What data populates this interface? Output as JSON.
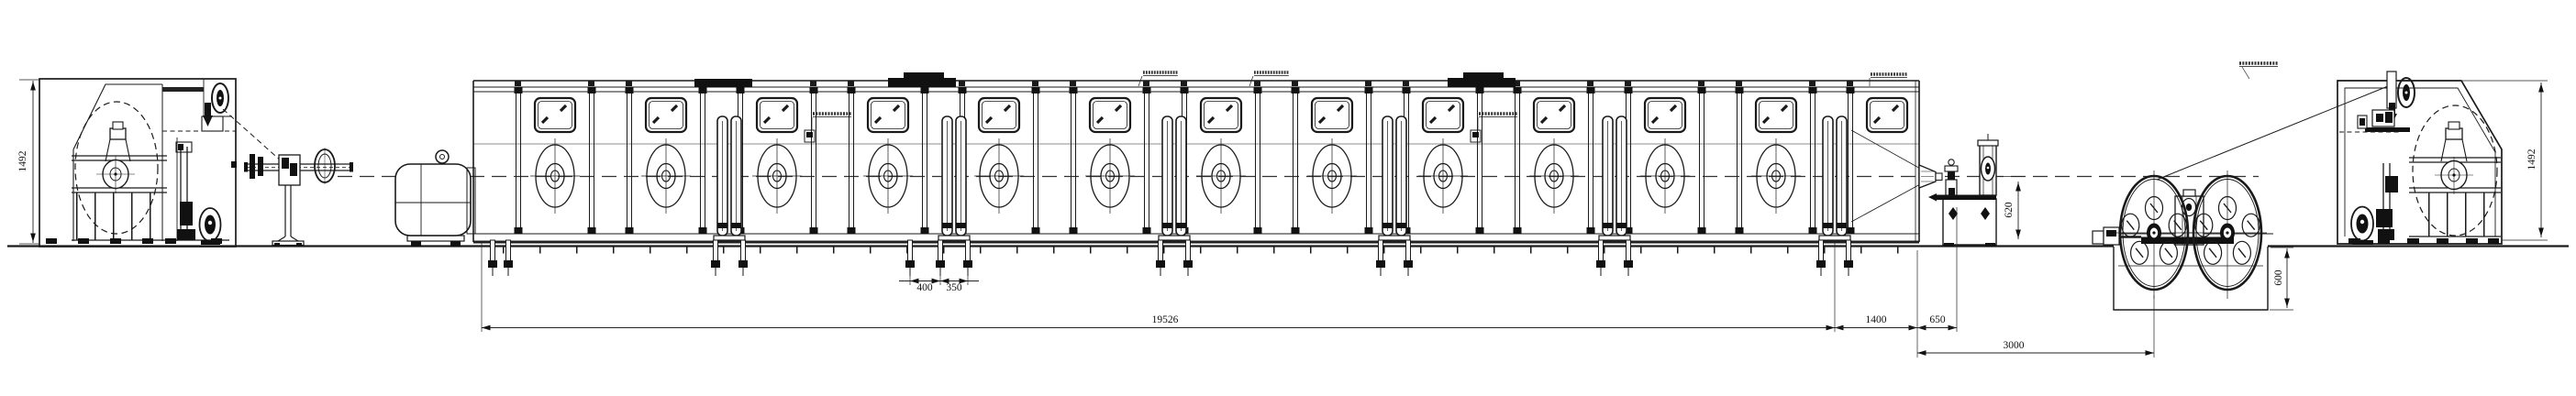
{
  "palette": {
    "ink": "#1a1a1a",
    "dim": "#222222",
    "background": "#ffffff"
  },
  "dimensions": {
    "payoff_height": "1492",
    "takeup_height": "1492",
    "main_line_length": "19526",
    "line_to_capstan": "1400",
    "capstan_stand_width": "650",
    "capstan_to_takeup_wheel": "3000",
    "anchor_bolt_pitch_left": "400",
    "anchor_bolt_pitch_right": "350",
    "capstan_centerline_height": "620",
    "pit_depth": "600"
  },
  "annotations": {
    "note": "six tiny leader labels, text illegible at source resolution",
    "items": [
      {
        "id": "ann-1",
        "legible": false
      },
      {
        "id": "ann-2",
        "legible": false
      },
      {
        "id": "ann-3",
        "legible": false
      },
      {
        "id": "ann-4",
        "legible": false
      },
      {
        "id": "ann-5",
        "legible": false
      },
      {
        "id": "ann-6",
        "legible": false
      }
    ]
  }
}
